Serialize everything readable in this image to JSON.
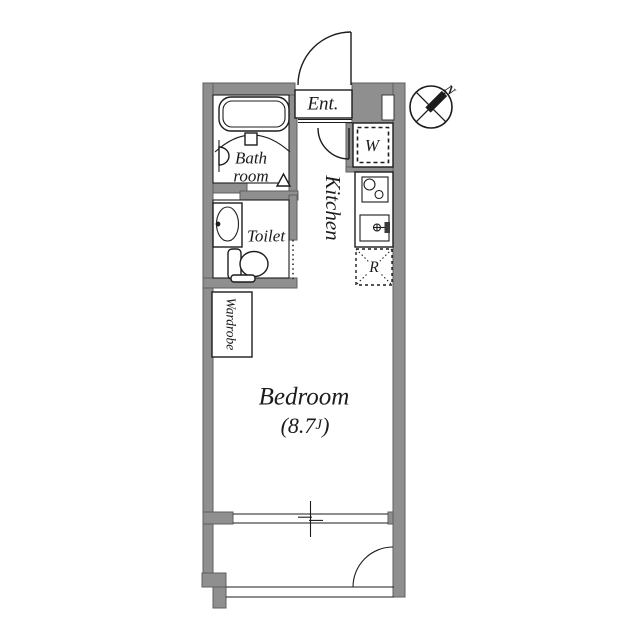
{
  "plan": {
    "labels": {
      "entrance": "Ent.",
      "bathroom_line1": "Bath",
      "bathroom_line2": "room",
      "toilet": "Toilet",
      "wardrobe": "Wardrobe",
      "kitchen": "Kitchen",
      "washer": "W",
      "refrigerator": "R",
      "bedroom": "Bedroom",
      "bedroom_area_prefix": "(8.7",
      "bedroom_area_unit": "J",
      "bedroom_area_suffix": ")",
      "compass_north": "N"
    },
    "colors": {
      "wall": "#8f8f8f",
      "wall_edge": "#5f5f5f",
      "line": "#1c1c1c",
      "background": "#ffffff"
    }
  }
}
